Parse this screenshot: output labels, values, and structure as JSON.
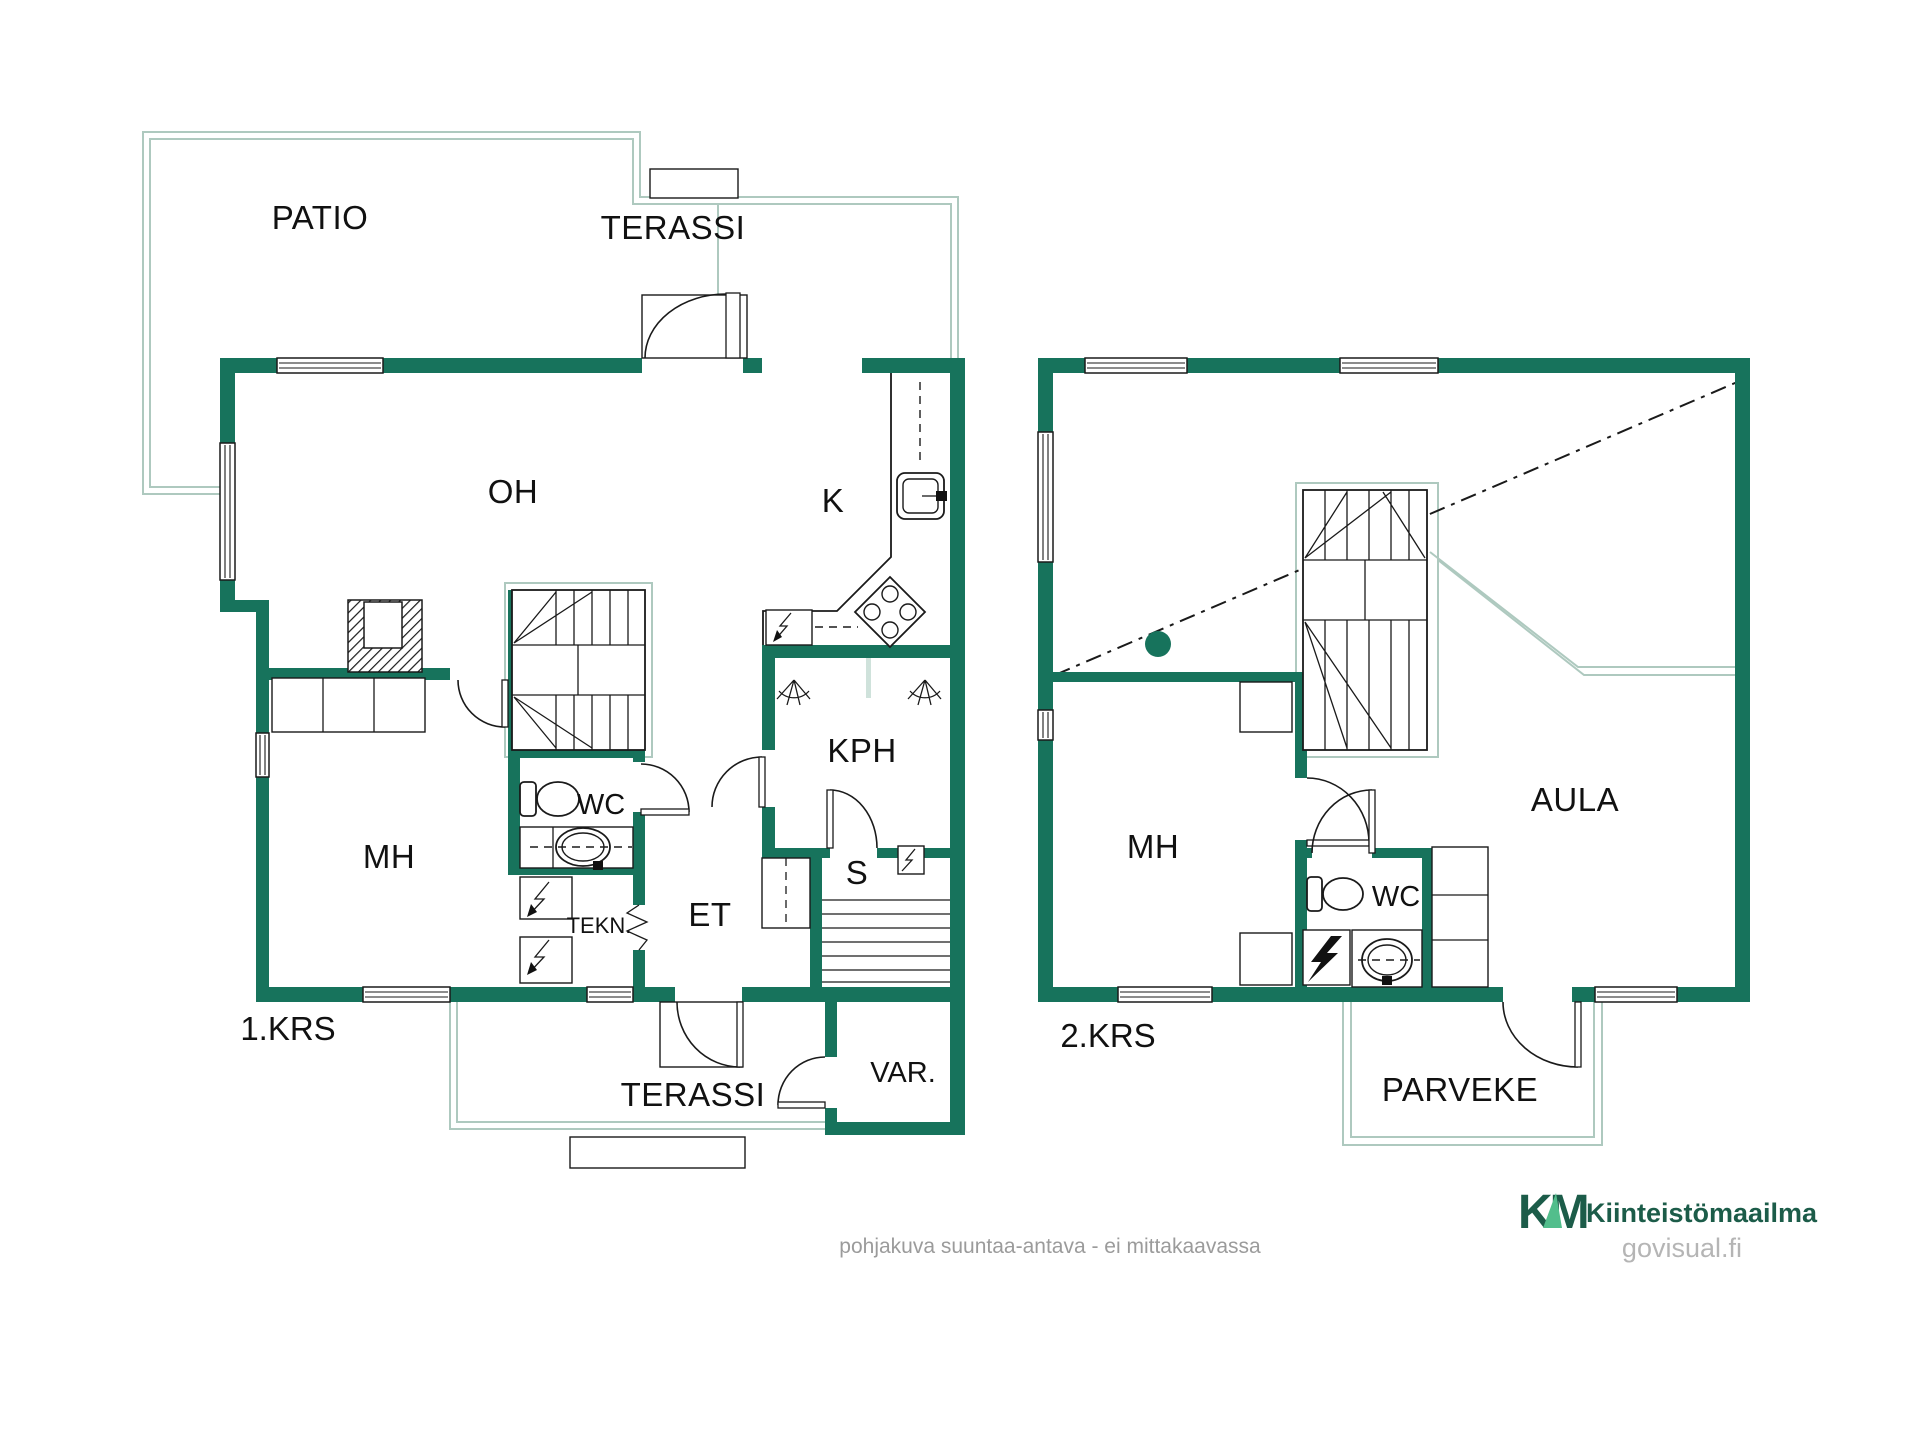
{
  "colors": {
    "wall_green": "#17735C",
    "outline_pale": "#AEC9BF",
    "line_black": "#1a1a1a",
    "logo_dark_green": "#1C5C49",
    "logo_light_green": "#52BE8C",
    "muted_gray": "#9b9b9b"
  },
  "floor1": {
    "label": "1.KRS",
    "rooms": {
      "patio": "PATIO",
      "terassi_top": "TERASSI",
      "oh": "OH",
      "k": "K",
      "mh": "MH",
      "wc": "WC",
      "tekn": "TEKN.",
      "et": "ET",
      "kph": "KPH",
      "s": "S",
      "var": "VAR.",
      "terassi_bottom": "TERASSI"
    }
  },
  "floor2": {
    "label": "2.KRS",
    "rooms": {
      "mh": "MH",
      "wc": "WC",
      "aula": "AULA",
      "parveke": "PARVEKE"
    }
  },
  "footer": {
    "disclaimer": "pohjakuva suuntaa-antava - ei mittakaavassa",
    "brand_mark": "KM",
    "brand": "Kiinteistömaailma",
    "website": "govisual.fi"
  }
}
